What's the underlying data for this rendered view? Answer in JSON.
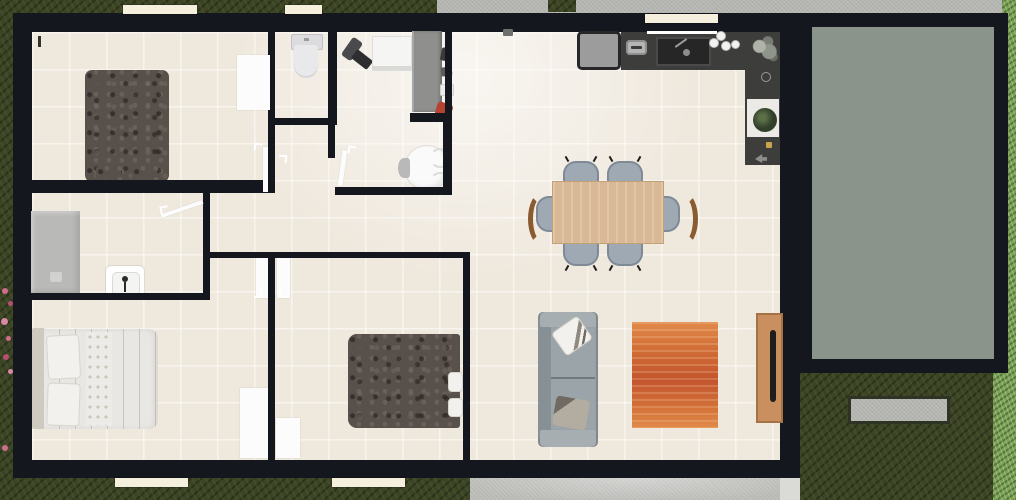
{
  "scene": {
    "type": "floor-plan",
    "view": "top-down-2d-render",
    "description": "Single-storey house plan with beige tiled floors, black walls, attached green-grey deck on the right, concrete paths top and bottom, lawn around"
  },
  "palette": {
    "wall": "#15171e",
    "floor": "#efe8dd",
    "grass_dark": "#3c4426",
    "grass_light": "#7ca35a",
    "concrete": "#b7b8b4",
    "path": "#c9cac6",
    "deck": "#8b948b",
    "window_sill": "#f5efdd",
    "door_white": "#fcfcfc",
    "counter": "#3d3d3c",
    "appliance_gray": "#9c9c9c",
    "table_wood": "#d9b896",
    "chair_gray": "#9fa9b4",
    "chair_arm_wood": "#8a5a30",
    "sofa_gray": "#9aa2a6",
    "rug_orange": "#cf6a35",
    "console_wood": "#c98f5e",
    "bed_dark": "#57504b",
    "bed_light": "#e9e7e3",
    "shower_gray": "#b9b9b7",
    "fixture_white": "#fafafa",
    "flower_pink": "#cf6d8d",
    "shoe_red": "#b5432f"
  },
  "rooms": [
    {
      "id": "bedroom-top-left",
      "contents": [
        "dark double bed",
        "open white door",
        "window"
      ]
    },
    {
      "id": "wc",
      "contents": [
        "toilet",
        "window"
      ]
    },
    {
      "id": "laundry-closet",
      "contents": [
        "vacuum cleaner",
        "washing machine",
        "grey wardrobe with shoes"
      ]
    },
    {
      "id": "small-round-table-room",
      "contents": [
        "round white table with chairs"
      ]
    },
    {
      "id": "ensuite-bathroom",
      "contents": [
        "grey shower",
        "white washbasin"
      ]
    },
    {
      "id": "bedroom-bottom-left",
      "contents": [
        "white double bed",
        "windows"
      ]
    },
    {
      "id": "bedroom-bottom-middle",
      "contents": [
        "dark double bed with white pillows",
        "window"
      ]
    },
    {
      "id": "open-living-kitchen-dining",
      "contents": [
        "L-shaped dark kitchen counter",
        "fridge",
        "sink",
        "hob",
        "plants",
        "dining table with six chairs",
        "grey sofa with cushions",
        "orange rug",
        "wooden tv console"
      ]
    }
  ],
  "exterior": [
    {
      "id": "deck",
      "surface": "green-grey"
    },
    {
      "id": "concrete-path-top"
    },
    {
      "id": "concrete-path-bottom"
    },
    {
      "id": "stone-step"
    },
    {
      "id": "pink-flowers-left-edge"
    },
    {
      "id": "light-grass-strip-right"
    }
  ],
  "counts": {
    "windows": 5,
    "open_door_leaves": 8,
    "dining_chairs": 6
  }
}
